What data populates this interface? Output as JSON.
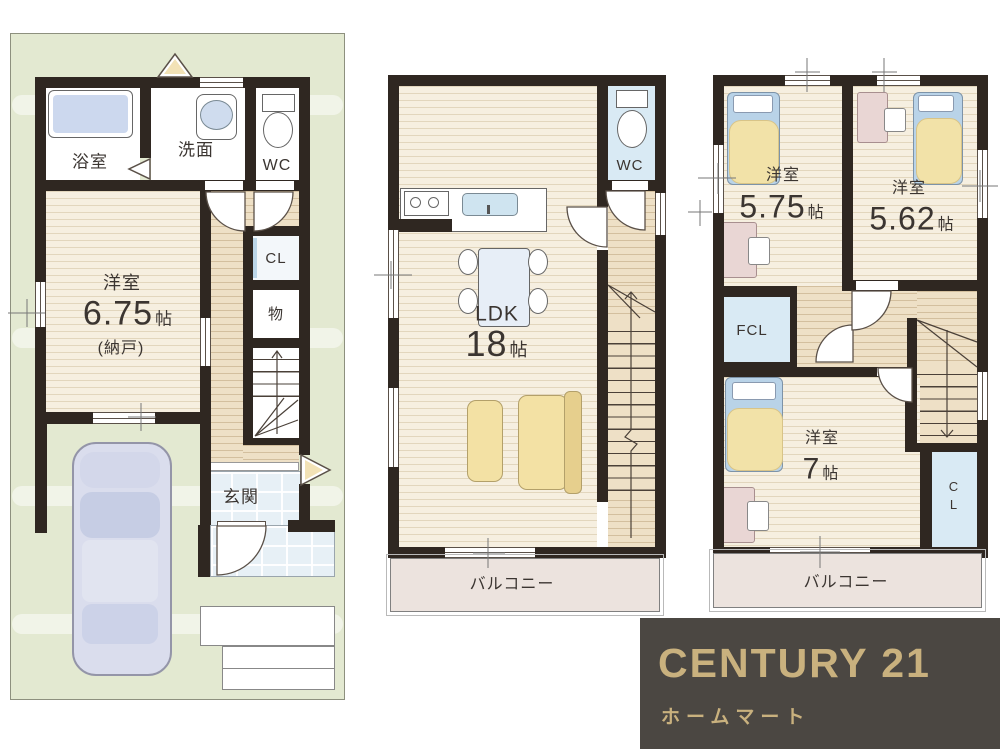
{
  "palette": {
    "wall": "#2f2721",
    "wood_floor": "#f6efe0",
    "hall_floor": "#eee0c6",
    "site_green": "#e3e9d1",
    "water_blue": "#d9eaf4",
    "tub_blue": "#ccd8ee",
    "furniture_yellow": "#f2e2a8",
    "balcony_pink": "#ece3de",
    "logo_background": "#4b4742",
    "logo_gold": "#c9b17e"
  },
  "units": {
    "jo": "帖"
  },
  "floor1": {
    "bath": "浴室",
    "washroom": "洗面",
    "wc": "WC",
    "bedroom": {
      "name": "洋室",
      "size": "6.75",
      "note": "(納戸)"
    },
    "closet": "CL",
    "storage": "物",
    "entrance": "玄関"
  },
  "floor2": {
    "wc": "WC",
    "ldk": {
      "name": "LDK",
      "size": "18"
    },
    "balcony": "バルコニー"
  },
  "floor3": {
    "room1": {
      "name": "洋室",
      "size": "5.75"
    },
    "room2": {
      "name": "洋室",
      "size": "5.62"
    },
    "room3": {
      "name": "洋室",
      "size": "7"
    },
    "fcl": "FCL",
    "closet_vertical": {
      "line1": "C",
      "line2": "L"
    },
    "balcony": "バルコニー"
  },
  "logo": {
    "brand": "CENTURY 21",
    "subtitle": "ホームマート"
  }
}
